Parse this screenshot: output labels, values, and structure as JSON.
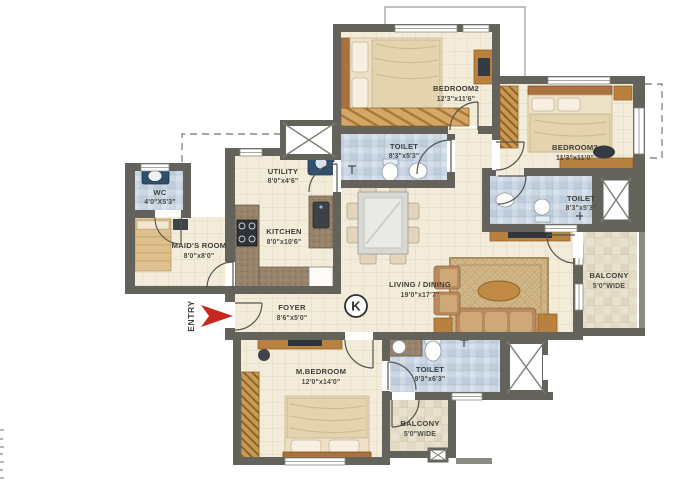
{
  "plan": {
    "entry": {
      "label": "ENTRY"
    },
    "compass": {
      "label": "K"
    },
    "rooms": [
      {
        "id": "bedroom2",
        "name": "BEDROOM2",
        "dims": "12'3\"x11'6\""
      },
      {
        "id": "bedroom3",
        "name": "BEDROOM3",
        "dims": "11'3\"x11'0\""
      },
      {
        "id": "toilet-bedroom2",
        "name": "TOILET",
        "dims": "8'3\"x5'3\""
      },
      {
        "id": "toilet-bedroom3",
        "name": "TOILET",
        "dims": "8'3\"x5'3\""
      },
      {
        "id": "wc",
        "name": "WC",
        "dims": "4'0\"X5'3\""
      },
      {
        "id": "maids-room",
        "name": "MAID'S ROOM",
        "dims": "8'0\"x8'0\""
      },
      {
        "id": "utility",
        "name": "UTILITY",
        "dims": "8'0\"x4'6\""
      },
      {
        "id": "kitchen",
        "name": "KITCHEN",
        "dims": "8'0\"x10'6\""
      },
      {
        "id": "foyer",
        "name": "FOYER",
        "dims": "8'6\"x5'0\""
      },
      {
        "id": "living-dining",
        "name": "LIVING / DINING",
        "dims": "19'0\"x17'7\""
      },
      {
        "id": "master-bedroom",
        "name": "M.BEDROOM",
        "dims": "12'0\"x14'0\""
      },
      {
        "id": "toilet-master",
        "name": "TOILET",
        "dims": "9'3\"x6'3\""
      },
      {
        "id": "balcony-right",
        "name": "BALCONY",
        "dims": "5'0\"WIDE"
      },
      {
        "id": "balcony-bottom",
        "name": "BALCONY",
        "dims": "5'0\"WIDE"
      }
    ],
    "colors": {
      "wall": "#63625b",
      "floor_cream": "#f3ecda",
      "floor_bath_blue": "#ccd8e4",
      "floor_balcony": "#e8e1ce",
      "wood": "#b8813f",
      "wardrobe_hatch": "#c99a56",
      "entry_arrow_red": "#c8281e",
      "dashed_line": "#8a8a84"
    }
  }
}
